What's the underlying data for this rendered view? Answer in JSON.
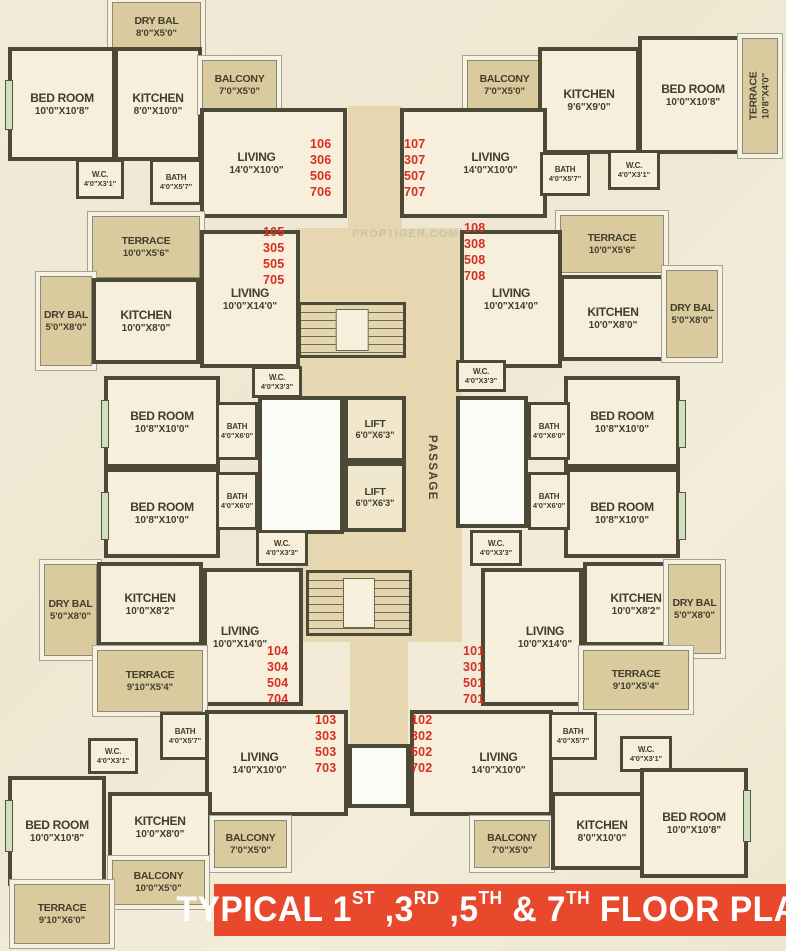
{
  "title": {
    "full": "TYPICAL 1ST ,3RD ,5TH & 7TH FLOOR PLAN",
    "segments": [
      {
        "t": "TYPICAL 1"
      },
      {
        "t": "ST",
        "sup": true
      },
      {
        "t": " ,3"
      },
      {
        "t": "RD",
        "sup": true
      },
      {
        "t": " ,5"
      },
      {
        "t": "TH",
        "sup": true
      },
      {
        "t": " & 7"
      },
      {
        "t": "TH",
        "sup": true
      },
      {
        "t": " FLOOR PLAN"
      }
    ]
  },
  "watermark": "PROPTIGER.COM",
  "labels": {
    "passage": "PASSAGE"
  },
  "colors": {
    "banner_red": "#e8492d",
    "unit_number_red": "#d62f22",
    "wall": "#4d4937",
    "room_fill": "#f7efdb",
    "open_area_fill": "#d9cb9e",
    "corridor_fill": "#e6d7b0"
  },
  "rooms": [
    {
      "id": "dry_bal_106",
      "name": "DRY BAL",
      "dims": "8'0\"X5'0\""
    },
    {
      "id": "bedroom_106",
      "name": "BED ROOM",
      "dims": "10'0\"X10'8\""
    },
    {
      "id": "kitchen_106",
      "name": "KITCHEN",
      "dims": "8'0\"X10'0\""
    },
    {
      "id": "balcony_106",
      "name": "BALCONY",
      "dims": "7'0\"X5'0\""
    },
    {
      "id": "living_106",
      "name": "LIVING",
      "dims": "14'0\"X10'0\""
    },
    {
      "id": "wc_106",
      "name": "W.C.",
      "dims": "4'0\"X3'1\""
    },
    {
      "id": "bath_106",
      "name": "BATH",
      "dims": "4'0\"X5'7\""
    },
    {
      "id": "balcony_107",
      "name": "BALCONY",
      "dims": "7'0\"X5'0\""
    },
    {
      "id": "kitchen_107",
      "name": "KITCHEN",
      "dims": "9'6\"X9'0\""
    },
    {
      "id": "bedroom_107",
      "name": "BED ROOM",
      "dims": "10'0\"X10'8\""
    },
    {
      "id": "terrace_107",
      "name": "TERRACE",
      "dims": "10'8\"X4'0\""
    },
    {
      "id": "living_107",
      "name": "LIVING",
      "dims": "14'0\"X10'0\""
    },
    {
      "id": "bath_107",
      "name": "BATH",
      "dims": "4'0\"X5'7\""
    },
    {
      "id": "wc_107",
      "name": "W.C.",
      "dims": "4'0\"X3'1\""
    },
    {
      "id": "terrace_105",
      "name": "TERRACE",
      "dims": "10'0\"X5'6\""
    },
    {
      "id": "living_105",
      "name": "LIVING",
      "dims": "10'0\"X14'0\""
    },
    {
      "id": "dry_bal_105",
      "name": "DRY BAL",
      "dims": "5'0\"X8'0\""
    },
    {
      "id": "kitchen_105",
      "name": "KITCHEN",
      "dims": "10'0\"X8'0\""
    },
    {
      "id": "wc_105",
      "name": "W.C.",
      "dims": "4'0\"X3'3\""
    },
    {
      "id": "bedroom_105",
      "name": "BED ROOM",
      "dims": "10'8\"X10'0\""
    },
    {
      "id": "bath_105",
      "name": "BATH",
      "dims": "4'0\"X6'0\""
    },
    {
      "id": "terrace_108",
      "name": "TERRACE",
      "dims": "10'0\"X5'6\""
    },
    {
      "id": "living_108",
      "name": "LIVING",
      "dims": "10'0\"X14'0\""
    },
    {
      "id": "kitchen_108",
      "name": "KITCHEN",
      "dims": "10'0\"X8'0\""
    },
    {
      "id": "dry_bal_108",
      "name": "DRY BAL",
      "dims": "5'0\"X8'0\""
    },
    {
      "id": "wc_108",
      "name": "W.C.",
      "dims": "4'0\"X3'3\""
    },
    {
      "id": "bedroom_108",
      "name": "BED ROOM",
      "dims": "10'8\"X10'0\""
    },
    {
      "id": "bath_108",
      "name": "BATH",
      "dims": "4'0\"X6'0\""
    },
    {
      "id": "bedroom_104",
      "name": "BED ROOM",
      "dims": "10'8\"X10'0\""
    },
    {
      "id": "bath_104",
      "name": "BATH",
      "dims": "4'0\"X6'0\""
    },
    {
      "id": "wc_104",
      "name": "W.C.",
      "dims": "4'0\"X3'3\""
    },
    {
      "id": "dry_bal_104",
      "name": "DRY BAL",
      "dims": "5'0\"X8'0\""
    },
    {
      "id": "kitchen_104",
      "name": "KITCHEN",
      "dims": "10'0\"X8'2\""
    },
    {
      "id": "living_104",
      "name": "LIVING",
      "dims": "10'0\"X14'0\""
    },
    {
      "id": "terrace_104",
      "name": "TERRACE",
      "dims": "9'10\"X5'4\""
    },
    {
      "id": "bedroom_101",
      "name": "BED ROOM",
      "dims": "10'8\"X10'0\""
    },
    {
      "id": "bath_101",
      "name": "BATH",
      "dims": "4'0\"X6'0\""
    },
    {
      "id": "wc_101",
      "name": "W.C.",
      "dims": "4'0\"X3'3\""
    },
    {
      "id": "living_101",
      "name": "LIVING",
      "dims": "10'0\"X14'0\""
    },
    {
      "id": "kitchen_101",
      "name": "KITCHEN",
      "dims": "10'0\"X8'2\""
    },
    {
      "id": "dry_bal_101",
      "name": "DRY BAL",
      "dims": "5'0\"X8'0\""
    },
    {
      "id": "terrace_101",
      "name": "TERRACE",
      "dims": "9'10\"X5'4\""
    },
    {
      "id": "bath_103",
      "name": "BATH",
      "dims": "4'0\"X5'7\""
    },
    {
      "id": "wc_103",
      "name": "W.C.",
      "dims": "4'0\"X3'1\""
    },
    {
      "id": "living_103",
      "name": "LIVING",
      "dims": "14'0\"X10'0\""
    },
    {
      "id": "bedroom_103",
      "name": "BED ROOM",
      "dims": "10'0\"X10'8\""
    },
    {
      "id": "kitchen_103",
      "name": "KITCHEN",
      "dims": "10'0\"X8'0\""
    },
    {
      "id": "balcony_103b",
      "name": "BALCONY",
      "dims": "7'0\"X5'0\""
    },
    {
      "id": "balcony_103a",
      "name": "BALCONY",
      "dims": "10'0\"X5'0\""
    },
    {
      "id": "terrace_103",
      "name": "TERRACE",
      "dims": "9'10\"X6'0\""
    },
    {
      "id": "living_102",
      "name": "LIVING",
      "dims": "14'0\"X10'0\""
    },
    {
      "id": "bath_102",
      "name": "BATH",
      "dims": "4'0\"X5'7\""
    },
    {
      "id": "wc_102",
      "name": "W.C.",
      "dims": "4'0\"X3'1\""
    },
    {
      "id": "balcony_102",
      "name": "BALCONY",
      "dims": "7'0\"X5'0\""
    },
    {
      "id": "kitchen_102",
      "name": "KITCHEN",
      "dims": "8'0\"X10'0\""
    },
    {
      "id": "bedroom_102",
      "name": "BED ROOM",
      "dims": "10'0\"X10'8\""
    },
    {
      "id": "lift_1",
      "name": "LIFT",
      "dims": "6'0\"X6'3\""
    },
    {
      "id": "lift_2",
      "name": "LIFT",
      "dims": "6'0\"X6'3\""
    }
  ],
  "units": [
    {
      "id": "u106",
      "numbers": [
        "106",
        "306",
        "506",
        "706"
      ]
    },
    {
      "id": "u107",
      "numbers": [
        "107",
        "307",
        "507",
        "707"
      ]
    },
    {
      "id": "u105",
      "numbers": [
        "105",
        "305",
        "505",
        "705"
      ]
    },
    {
      "id": "u108",
      "numbers": [
        "108",
        "308",
        "508",
        "708"
      ]
    },
    {
      "id": "u104",
      "numbers": [
        "104",
        "304",
        "504",
        "704"
      ]
    },
    {
      "id": "u101",
      "numbers": [
        "101",
        "301",
        "501",
        "701"
      ]
    },
    {
      "id": "u103",
      "numbers": [
        "103",
        "303",
        "503",
        "703"
      ]
    },
    {
      "id": "u102",
      "numbers": [
        "102",
        "302",
        "502",
        "702"
      ]
    }
  ]
}
